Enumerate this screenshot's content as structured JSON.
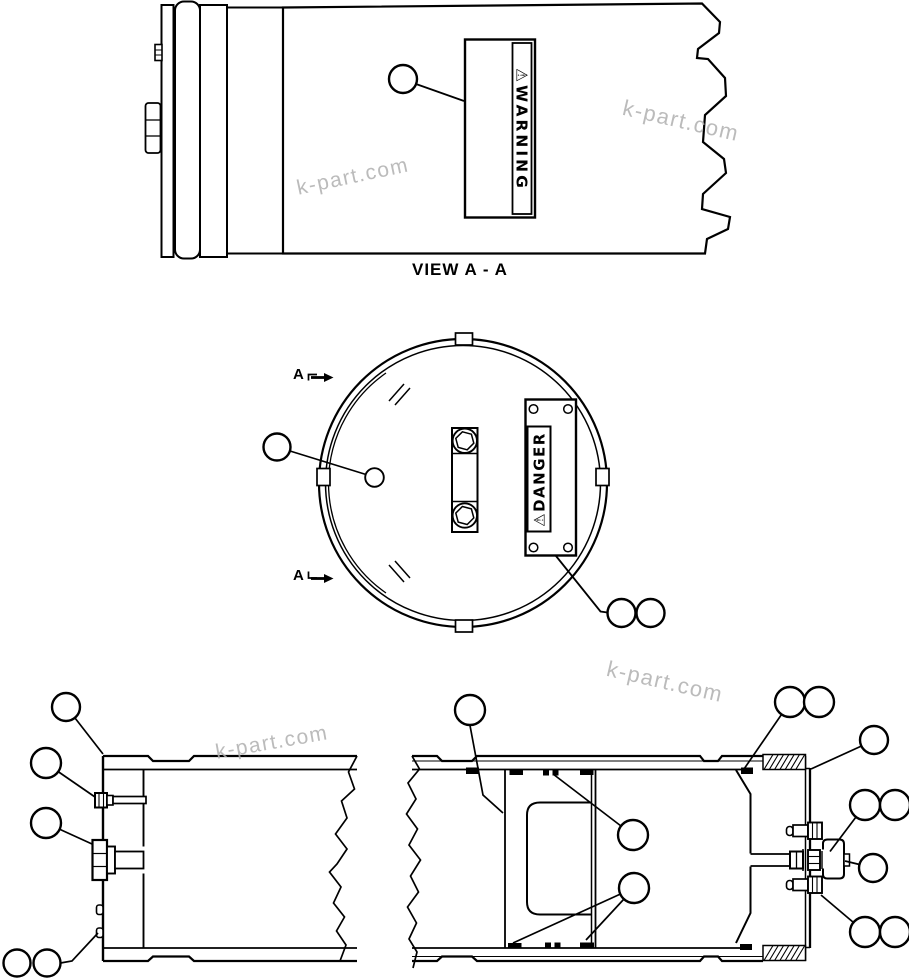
{
  "colors": {
    "line": "#000000",
    "background": "#ffffff",
    "watermark": "#b0b0b0"
  },
  "top_view": {
    "caption": "VIEW  A - A",
    "warning_label": "⚠WARNING"
  },
  "end_view": {
    "danger_label": "⚠DANGER",
    "section_label_top": "A",
    "section_label_bottom": "A"
  },
  "watermarks": [
    {
      "text": "k-part.com"
    },
    {
      "text": "k-part.com"
    },
    {
      "text": "k-part.com"
    },
    {
      "text": "k-part.com"
    }
  ]
}
